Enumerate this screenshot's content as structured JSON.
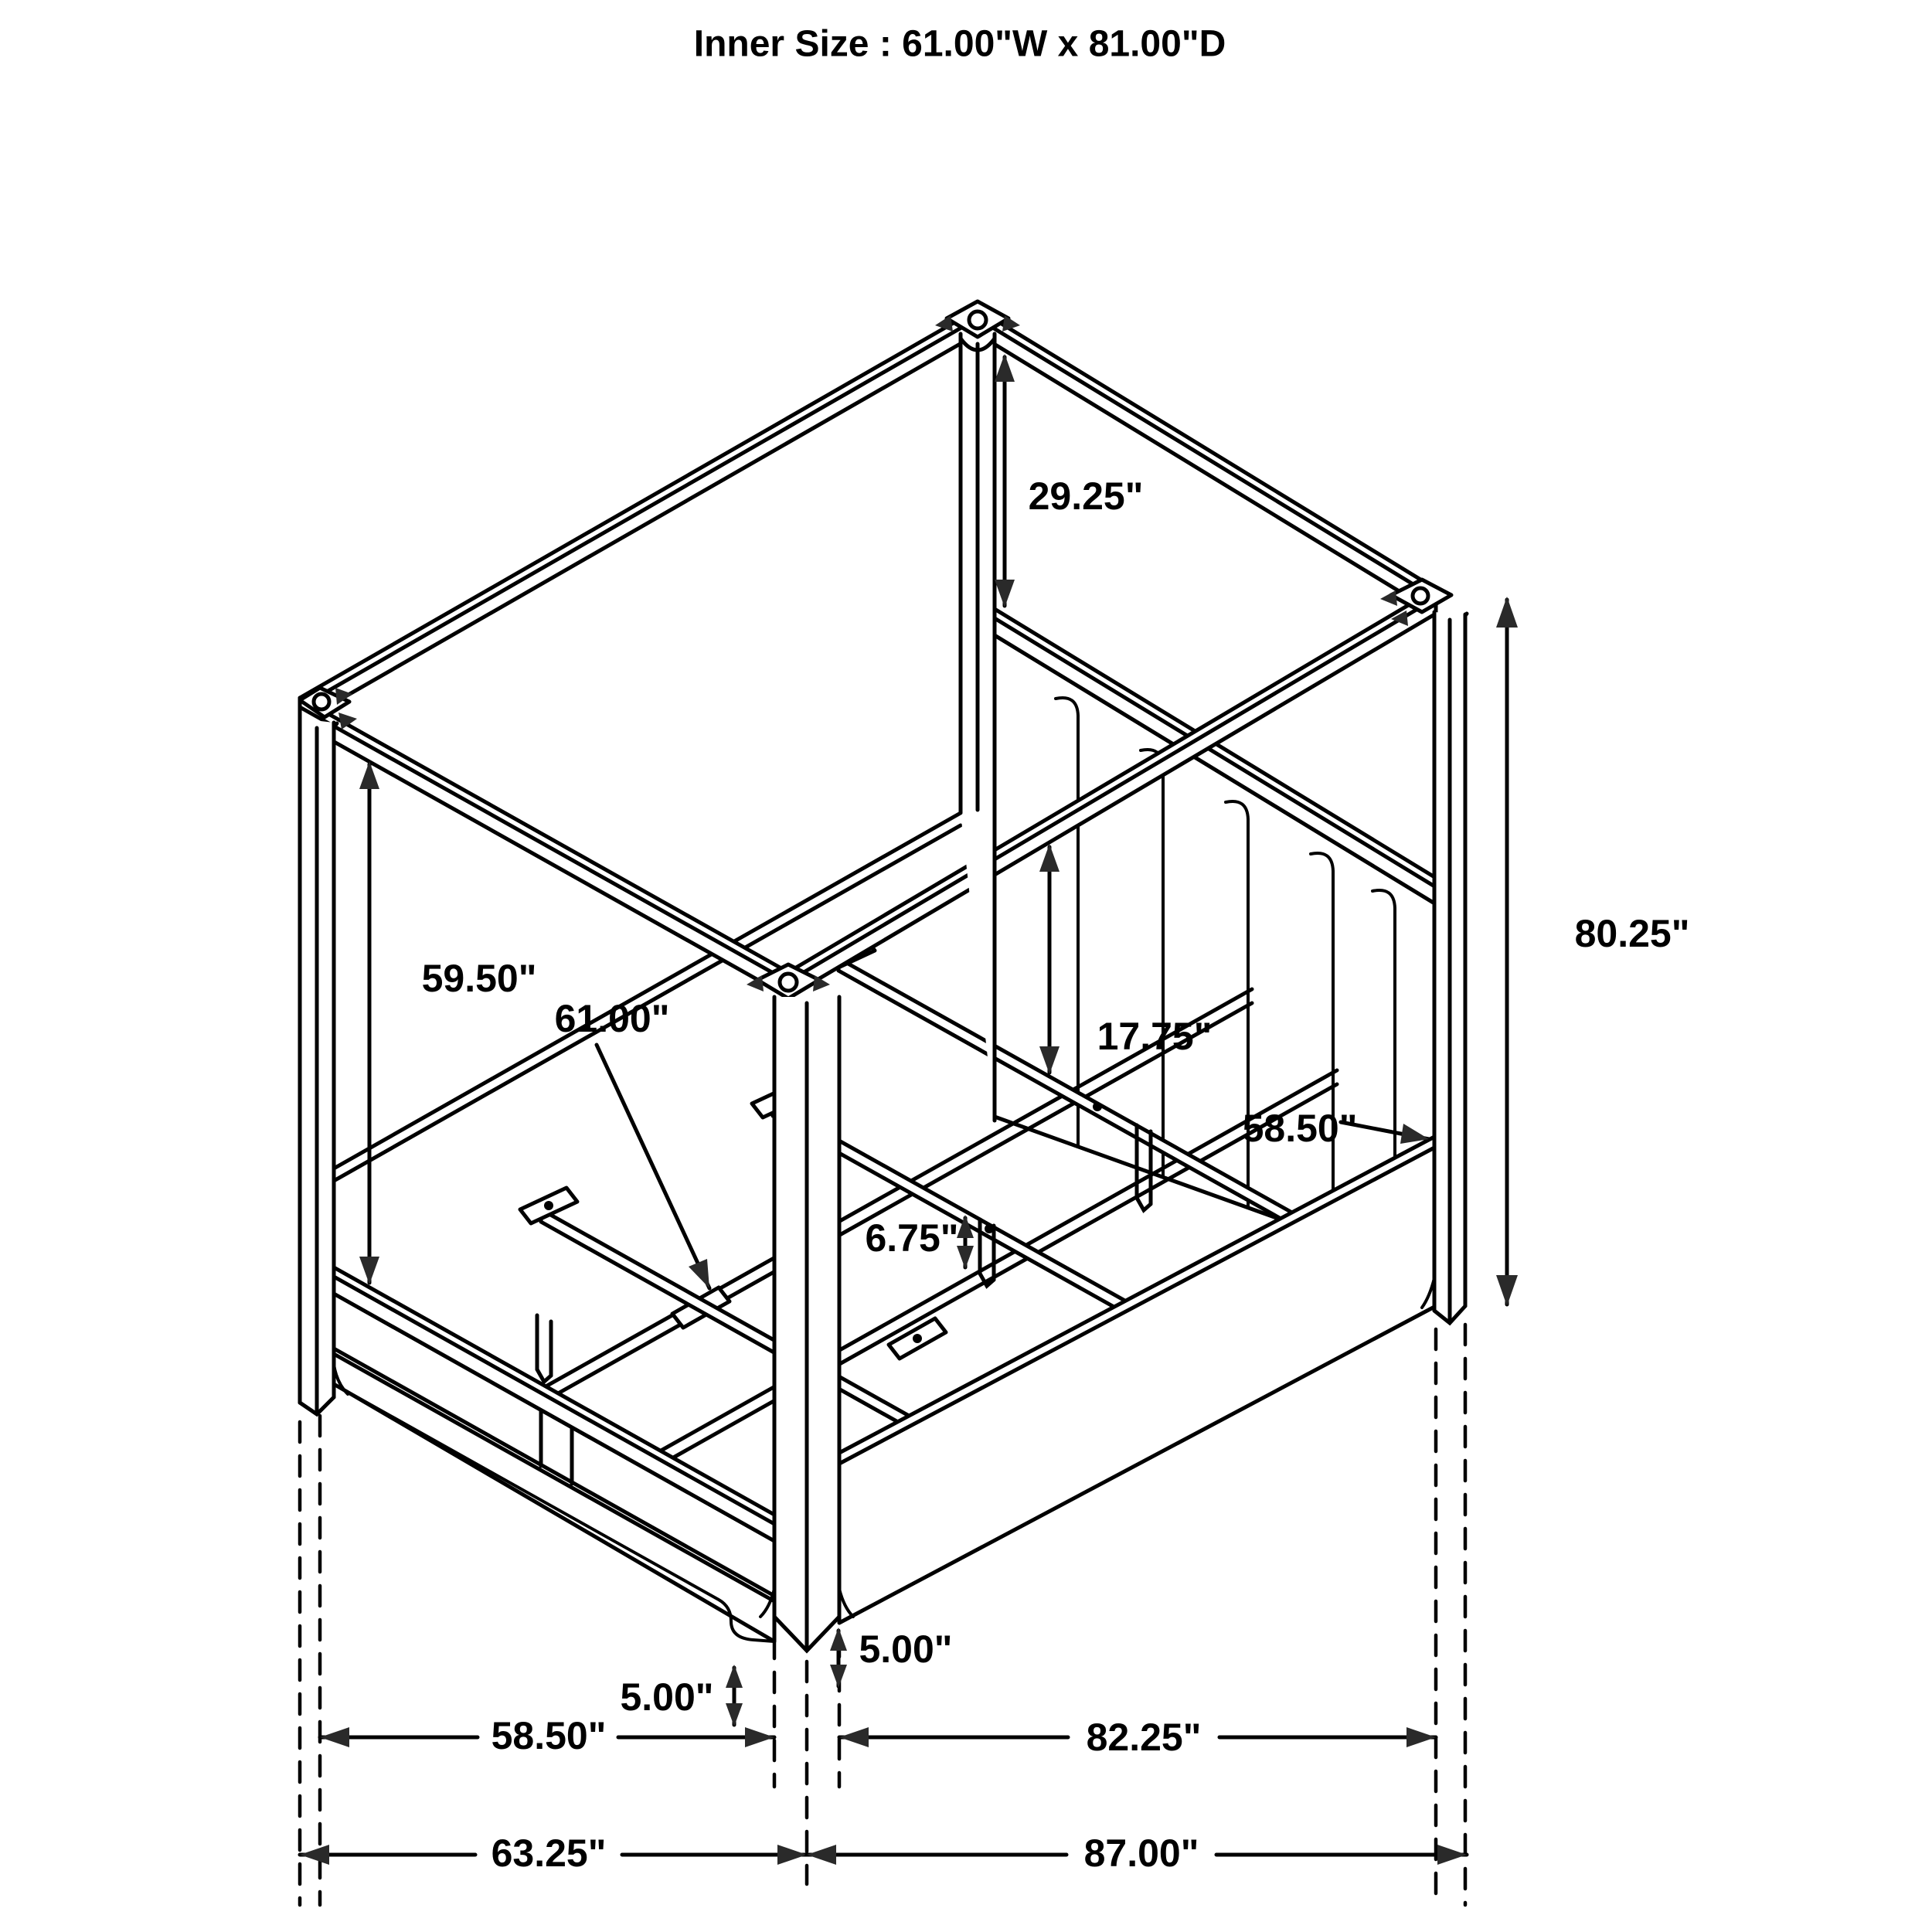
{
  "title": "Inner Size : 61.00\"W x 81.00\"D",
  "dimensions": {
    "canopy_to_headboard": {
      "text": "29.25\""
    },
    "overall_height": {
      "text": "80.25\""
    },
    "post_clearance": {
      "text": "59.50\""
    },
    "slat_length": {
      "text": "61.00\""
    },
    "rail_height": {
      "text": "17.75\""
    },
    "side_rail_top": {
      "text": "58.50\""
    },
    "leg_height": {
      "text": "6.75\""
    },
    "foot_height_left": {
      "text": "5.00\""
    },
    "foot_height_right": {
      "text": "5.00\""
    },
    "footboard_width": {
      "text": "58.50\""
    },
    "side_rail_length": {
      "text": "82.25\""
    },
    "overall_width": {
      "text": "63.25\""
    },
    "overall_depth": {
      "text": "87.00\""
    }
  }
}
